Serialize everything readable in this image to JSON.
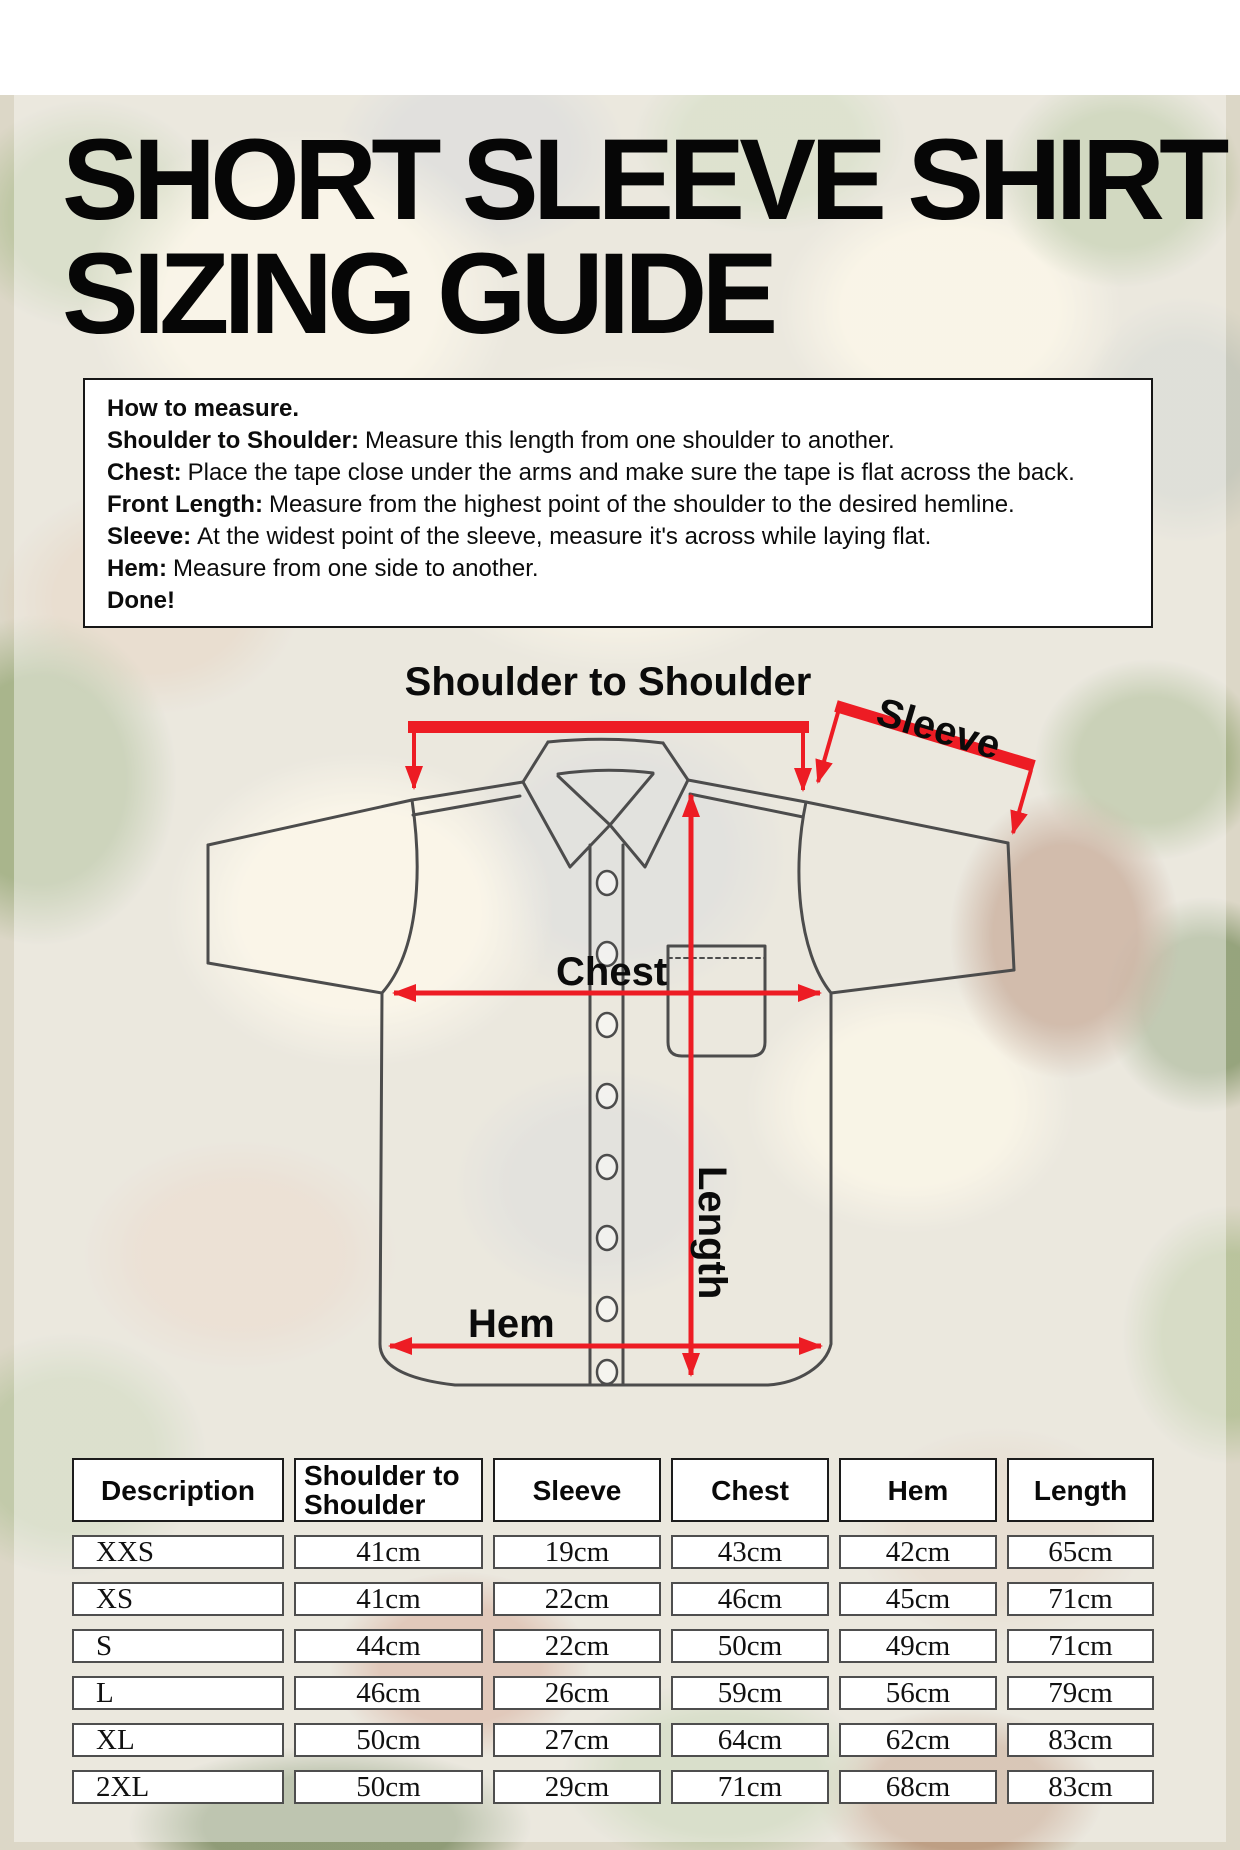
{
  "title": {
    "line1": "SHORT SLEEVE SHIRT",
    "line2": "SIZING GUIDE"
  },
  "instructions": {
    "items": [
      {
        "label": "How to measure.",
        "text": ""
      },
      {
        "label": "Shoulder to Shoulder:",
        "text": "Measure this length from one shoulder to another."
      },
      {
        "label": "Chest:",
        "text": "Place the tape close under the arms and make sure the tape is flat across the back."
      },
      {
        "label": "Front Length:",
        "text": "Measure from the highest point of the shoulder to the desired hemline."
      },
      {
        "label": "Sleeve:",
        "text": "At the widest point of the sleeve, measure it's across while laying flat."
      },
      {
        "label": "Hem:",
        "text": "Measure from one side to another."
      },
      {
        "label": "Done!",
        "text": ""
      }
    ]
  },
  "diagram": {
    "labels": {
      "shoulder_to_shoulder": "Shoulder to Shoulder",
      "sleeve": "Sleeve",
      "chest": "Chest",
      "length": "Length",
      "hem": "Hem"
    }
  },
  "table": {
    "headers": [
      "Description",
      "Shoulder to Shoulder",
      "Sleeve",
      "Chest",
      "Hem",
      "Length"
    ],
    "rows": [
      [
        "XXS",
        "41cm",
        "19cm",
        "43cm",
        "42cm",
        "65cm"
      ],
      [
        "XS",
        "41cm",
        "22cm",
        "46cm",
        "45cm",
        "71cm"
      ],
      [
        "S",
        "44cm",
        "22cm",
        "50cm",
        "49cm",
        "71cm"
      ],
      [
        "L",
        "46cm",
        "26cm",
        "59cm",
        "56cm",
        "79cm"
      ],
      [
        "XL",
        "50cm",
        "27cm",
        "64cm",
        "62cm",
        "83cm"
      ],
      [
        "2XL",
        "50cm",
        "29cm",
        "71cm",
        "68cm",
        "83cm"
      ]
    ]
  },
  "colors": {
    "accent_red": "#ed1c24",
    "outline_grey": "#4c4c4c"
  }
}
